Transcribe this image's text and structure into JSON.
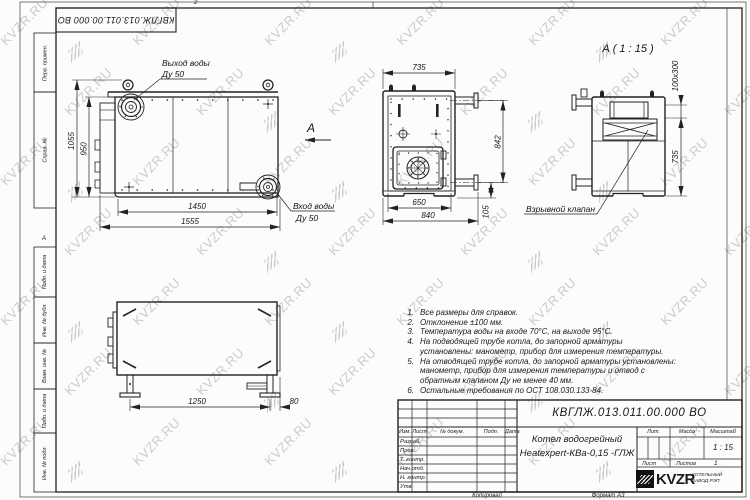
{
  "watermark": {
    "text": "KVZR.RU",
    "color": "#bfbfbf"
  },
  "colors": {
    "line": "#222222",
    "background": "#fcfcfb",
    "logo_bg": "#111111"
  },
  "zones": {
    "top": "2",
    "left": "А"
  },
  "corner_stamp": "КВГЛЖ.013.011.00.000 ВО",
  "margin_stamps": [
    "Перв. примен.",
    "Справ. №",
    "Подп. и дата",
    "Инв. № дубл.",
    "Взам. инв. №",
    "Подп. и дата",
    "Инв. № подл."
  ],
  "front": {
    "dim_height_outer": "1055",
    "dim_height_inner": "950",
    "dim_width_inner": "1450",
    "dim_width_outer": "1555",
    "outlet_label": "Выход воды",
    "outlet_size": "Ду 50",
    "inlet_label": "Вход воды",
    "inlet_size": "Ду 50",
    "view_arrow": "А"
  },
  "side": {
    "dim_top": "735",
    "dim_right": "842",
    "dim_bottom_inner": "650",
    "dim_bottom_outer": "840",
    "dim_pipe": "105",
    "valve_label": "Взрывной клапан"
  },
  "detail": {
    "title": "А ( 1 : 15 )",
    "dim_slot": "100х300",
    "dim_height": "735"
  },
  "bottom_view": {
    "dim_span": "1250",
    "dim_offset": "80"
  },
  "notes": [
    "Все размеры для справок.",
    "Отклонение ±100 мм.",
    "Температура воды на входе 70°С, на выходе 95°С.",
    "На подводящей трубе котла, до запорной арматуры установлены: манометр, прибор для измерения температуры.",
    "На отводящей трубе котла, до запорной арматуры установлены: манометр, прибор для измерения температуры и отвод с обратным клапаном Ду не менее 40 мм.",
    "Остальные требования по ОСТ 108.030.133-84."
  ],
  "title_block": {
    "doc_number": "КВГЛЖ.013.011.00.000 ВО",
    "product_name_line1": "Котел водогрейный",
    "product_name_line2": "Heatexpert-КВа-0,15 -ГЛЖ",
    "rev_headers": [
      "Изм.",
      "Лист",
      "№ докум.",
      "Подп.",
      "Дата"
    ],
    "roles": [
      "Разраб.",
      "Пров.",
      "Т. контр.",
      "Нач.отд.",
      "Н. контр.",
      "Утв."
    ],
    "lit_label": "Лит.",
    "mass_label": "Масса",
    "scale_label": "Масштаб",
    "scale_value": "1 : 15",
    "sheet_label": "Лист",
    "sheets_label": "Листов",
    "sheets_value": "1",
    "logo_text": "KVZR",
    "logo_caption_line1": "КОТЕЛЬНЫЙ",
    "logo_caption_line2": "ЗАВОД РЭП",
    "copied_label": "Копировал",
    "format_label": "Формат А3"
  }
}
